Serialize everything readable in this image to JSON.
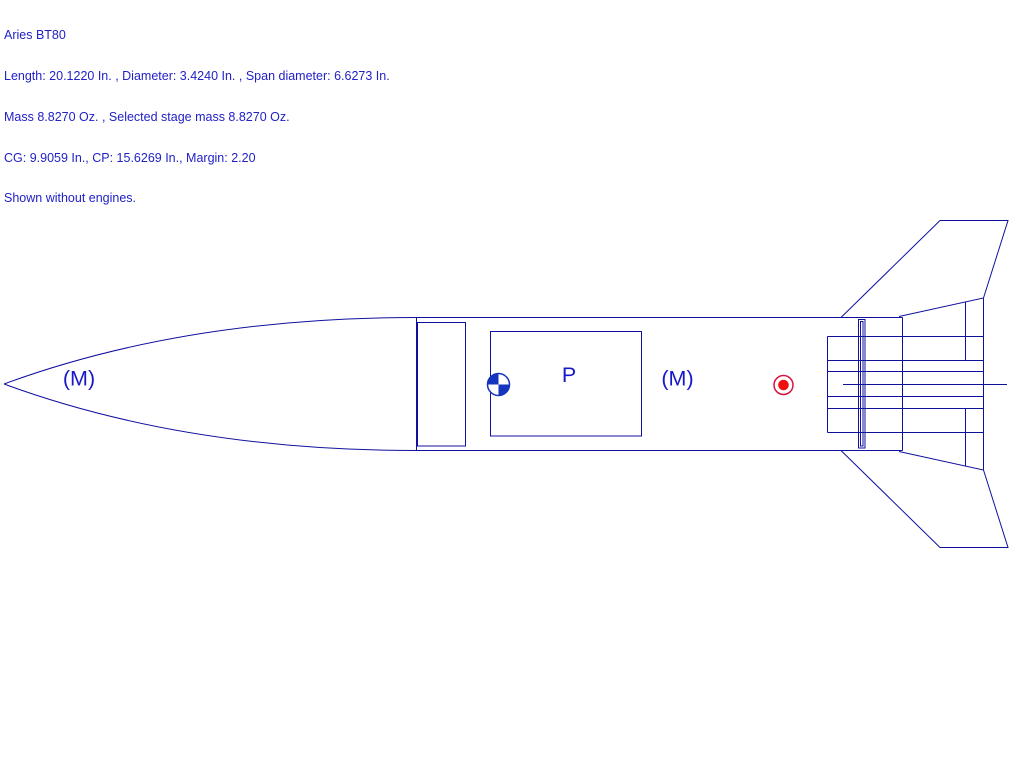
{
  "header": {
    "lines": [
      "Aries BT80",
      "Length: 20.1220 In. , Diameter: 3.4240 In. , Span diameter: 6.6273 In.",
      "Mass 8.8270 Oz. , Selected stage mass 8.8270 Oz.",
      "CG: 9.9059 In., CP: 15.6269 In., Margin: 2.20",
      "Shown without engines."
    ]
  },
  "rocket": {
    "name": "Aries BT80",
    "length_in": "20.1220",
    "diameter_in": "3.4240",
    "span_diameter_in": "6.6273",
    "mass_oz": "8.8270",
    "selected_stage_mass_oz": "8.8270",
    "cg_in": "9.9059",
    "cp_in": "15.6269",
    "margin": "2.20"
  },
  "diagram": {
    "labels": {
      "nose_mass": "(M)",
      "parachute": "P",
      "body_mass": "(M)"
    },
    "markers": {
      "cg_icon": "cg-checker-circle",
      "cp_icon": "cp-red-dot-circle"
    },
    "colors": {
      "line_blue": "#10109e",
      "text_blue": "#2121c8",
      "label_blue": "#1818c8",
      "cg_fill_blue": "#1535be",
      "cp_ring_red": "#d8123c",
      "cp_dot_red": "#ee1111",
      "background": "#ffffff"
    }
  }
}
